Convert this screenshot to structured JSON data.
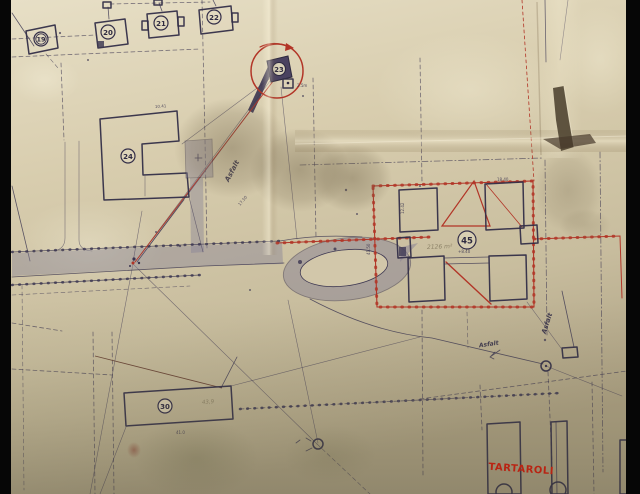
{
  "document_type": "aged paper site plan photograph",
  "palette": {
    "paper_light": "#e7dfc6",
    "paper_mid": "#d5caab",
    "paper_dark": "#ab9f82",
    "ink": "#3a3450",
    "red": "#b23527",
    "red_text": "#d6190a",
    "pencil": "#8d8268",
    "road_fill": "#8a8496",
    "photo_edge": "#060606"
  },
  "buildings": [
    {
      "id": "b19",
      "number": "19"
    },
    {
      "id": "b20",
      "number": "20"
    },
    {
      "id": "b21",
      "number": "21"
    },
    {
      "id": "b22",
      "number": "22"
    },
    {
      "id": "b23",
      "number": "23"
    },
    {
      "id": "b24",
      "number": "24"
    },
    {
      "id": "b45",
      "number": "45"
    },
    {
      "id": "b30",
      "number": "30"
    }
  ],
  "annotations": {
    "asfalt_upper": "Asfalt",
    "asfalt_right": "Asfalt",
    "asfalt_arrow": "Asfalt",
    "marker_height": "2.5m",
    "area_pencil": "2126 m²",
    "length_pencil": "43,9",
    "site_name_red": "TARTAROLI"
  },
  "dimensions": [
    "18.40",
    "+8.40",
    "41.50",
    "12.42",
    "10.41",
    "17.50",
    "41.0"
  ]
}
